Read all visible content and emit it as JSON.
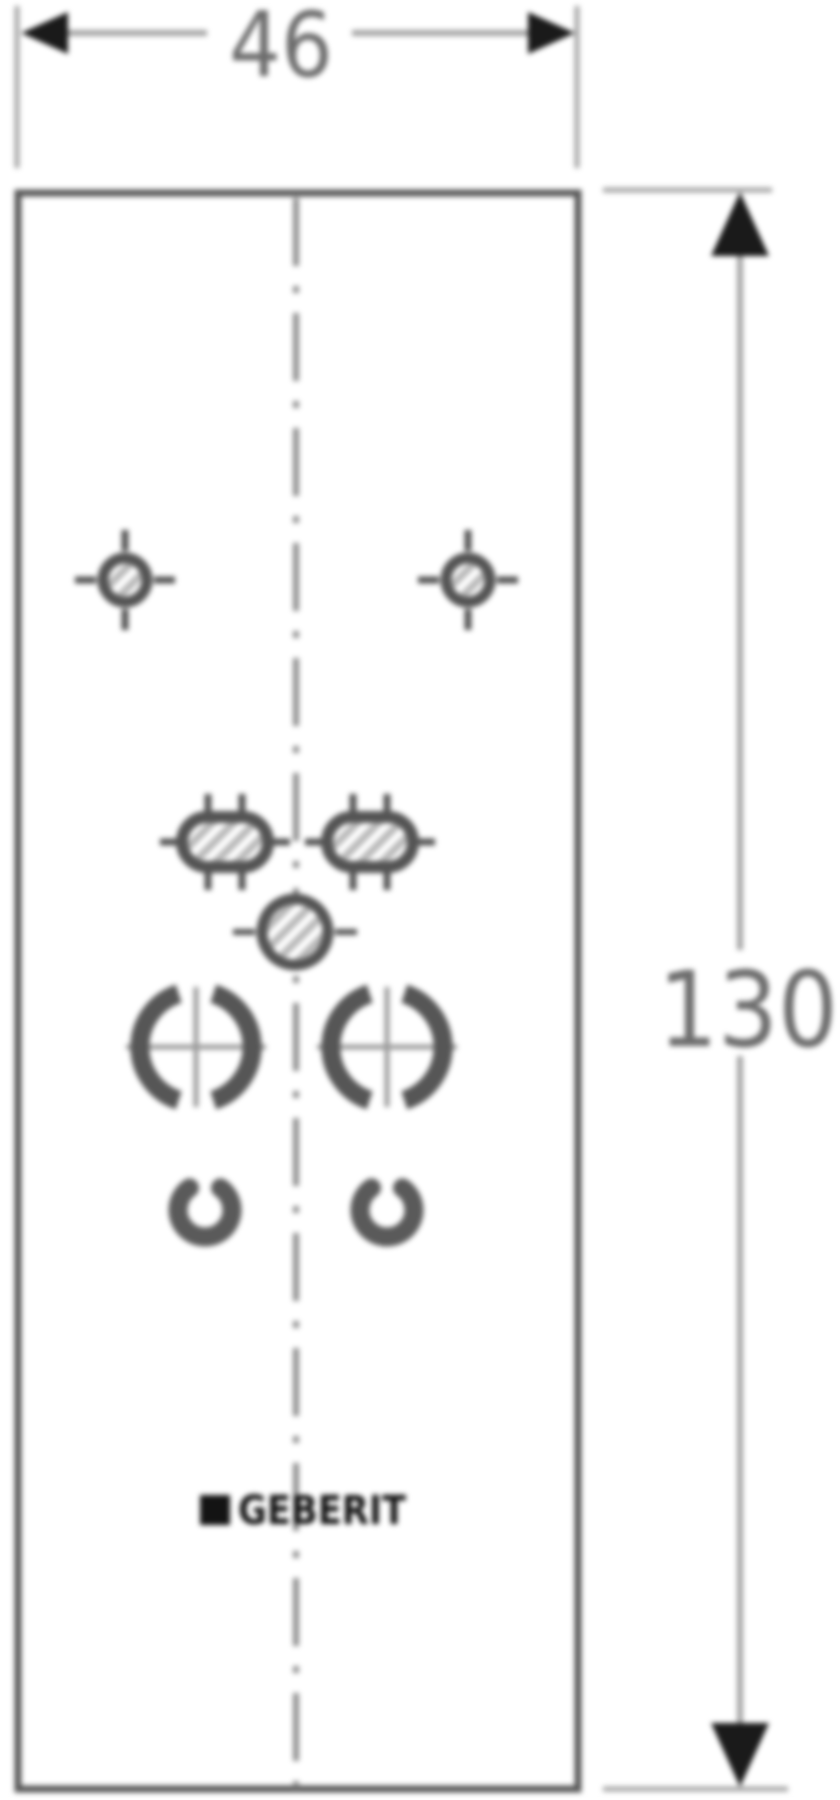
{
  "page": {
    "background": "#ffffff"
  },
  "drawing": {
    "type": "technical-dimension-drawing",
    "width_dimension": {
      "value": "46"
    },
    "height_dimension": {
      "value": "130"
    },
    "logo_text": "GEBERIT",
    "colors": {
      "outline": "#585858",
      "symbol": "#545454",
      "dimension_line": "#a3a3a3",
      "extension_line": "#a6a6a6",
      "arrowhead": "#1a1a1a",
      "dimension_text": "#6d6d6d",
      "centerline": "#8f8f8f",
      "crosshair": "#9a9a9a",
      "hatch": "#b8b8b8",
      "logo": "#131313"
    }
  }
}
